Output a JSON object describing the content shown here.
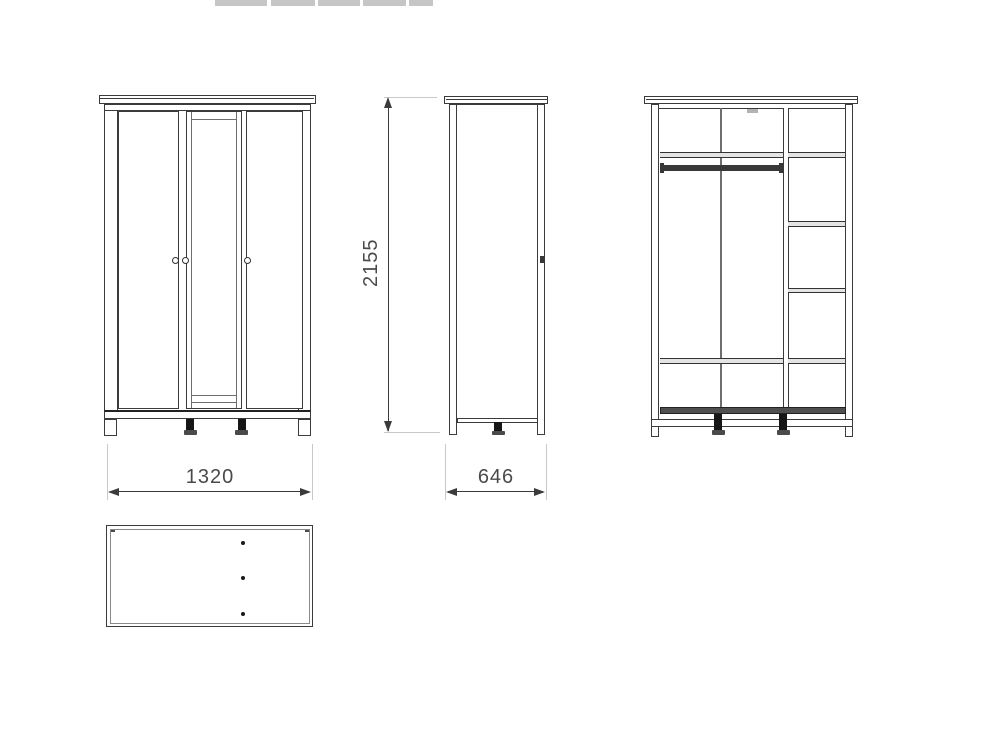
{
  "dimensions": {
    "width": "1320",
    "depth": "646",
    "height": "2155"
  },
  "colors": {
    "line": "#3b3b3b",
    "dimension_text": "#4a4a4a",
    "extension_line": "#c9c9c9",
    "shelf_fill": "#e4e4e4",
    "hanging_rail": "#383838",
    "foot": "#161616",
    "watermark_fragment": "#c6c6c6",
    "background": "#ffffff"
  }
}
